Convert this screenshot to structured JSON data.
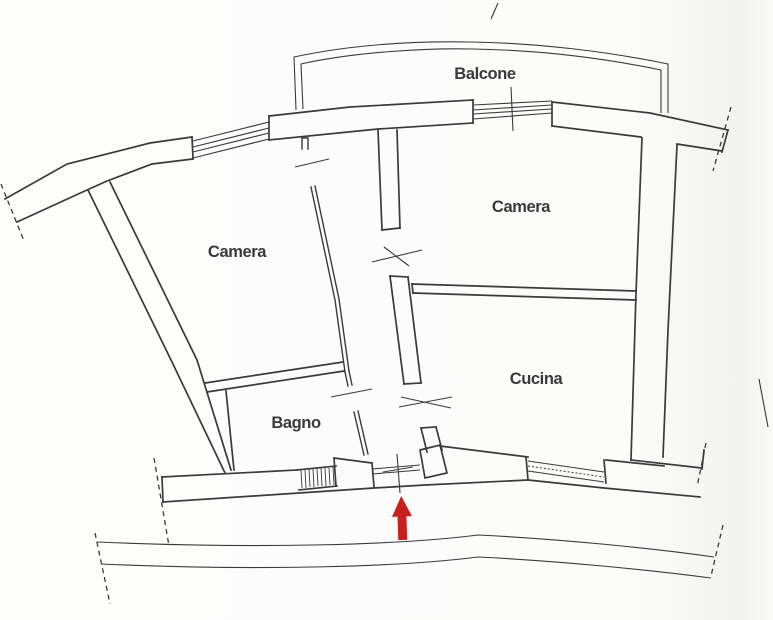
{
  "document": {
    "type": "floor-plan",
    "language": "Italian"
  },
  "labels": {
    "balcone": "Balcone",
    "camera_left": "Camera",
    "camera_right": "Camera",
    "cucina": "Cucina",
    "bagno": "Bagno"
  },
  "entrance_arrow": {
    "direction": "up",
    "color": "#c8201e"
  },
  "colors": {
    "ink": "#3a3a3a",
    "paper": "#fcfcfb"
  }
}
